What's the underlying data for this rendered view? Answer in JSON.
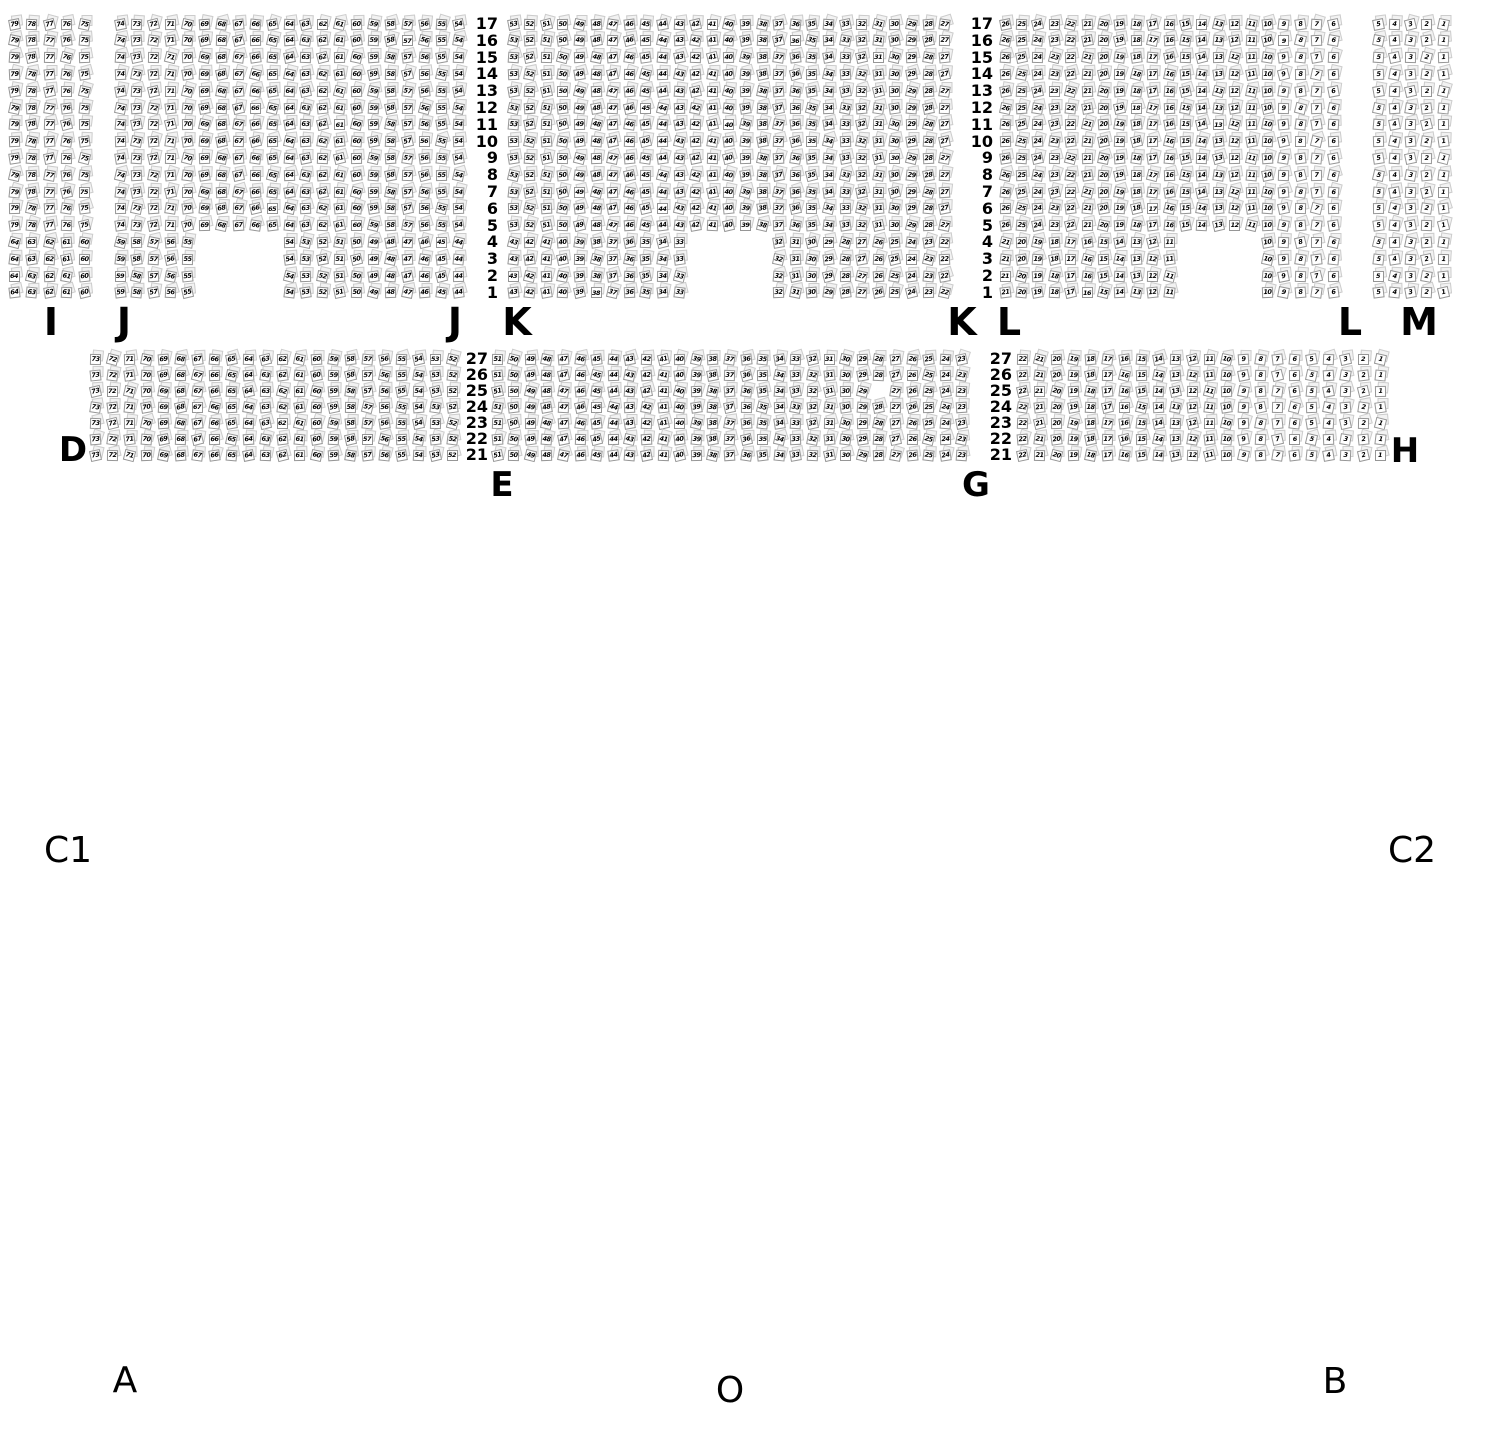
{
  "section_labels": {
    "tier1": [
      "I",
      "J",
      "J",
      "K",
      "K",
      "L",
      "L",
      "M"
    ],
    "tier2": [
      "D",
      "E",
      "G",
      "H"
    ]
  },
  "floor_labels": [
    "C1",
    "C2",
    "A",
    "O",
    "B"
  ],
  "tier1": {
    "row_numbers": [
      17,
      16,
      15,
      14,
      13,
      12,
      11,
      10,
      9,
      8,
      7,
      6,
      5,
      4,
      3,
      2,
      1
    ],
    "blocks": [
      {
        "id": "I",
        "groups": [
          {
            "rows": [
              17,
              5
            ],
            "segments": [
              {
                "from": 79,
                "to": 75,
                "col": 0
              }
            ]
          },
          {
            "rows": [
              4,
              1
            ],
            "segments": [
              {
                "from": 64,
                "to": 60,
                "col": 0
              }
            ]
          }
        ]
      },
      {
        "id": "J",
        "groups": [
          {
            "rows": [
              17,
              5
            ],
            "segments": [
              {
                "from": 74,
                "to": 54,
                "col": 0
              }
            ]
          },
          {
            "rows": [
              4,
              1
            ],
            "segments": [
              {
                "from": 59,
                "to": 55,
                "col": 0
              },
              {
                "from": 54,
                "to": 44,
                "col": 10
              }
            ]
          }
        ]
      },
      {
        "id": "K",
        "groups": [
          {
            "rows": [
              17,
              5
            ],
            "segments": [
              {
                "from": 53,
                "to": 27,
                "col": 0
              }
            ]
          },
          {
            "rows": [
              4,
              1
            ],
            "segments": [
              {
                "from": 43,
                "to": 33,
                "col": 0
              },
              {
                "from": 32,
                "to": 22,
                "col": 16
              }
            ]
          }
        ]
      },
      {
        "id": "L",
        "groups": [
          {
            "rows": [
              17,
              5
            ],
            "segments": [
              {
                "from": 26,
                "to": 6,
                "col": 0
              }
            ]
          },
          {
            "rows": [
              4,
              1
            ],
            "segments": [
              {
                "from": 21,
                "to": 11,
                "col": 0
              },
              {
                "from": 10,
                "to": 6,
                "col": 16
              }
            ]
          }
        ]
      },
      {
        "id": "M",
        "groups": [
          {
            "rows": [
              17,
              1
            ],
            "segments": [
              {
                "from": 5,
                "to": 1,
                "col": 0
              }
            ]
          }
        ]
      }
    ]
  },
  "tier2": {
    "row_numbers": [
      27,
      26,
      25,
      24,
      23,
      22,
      21
    ],
    "blocks": [
      {
        "id": "D",
        "groups": [
          {
            "rows": [
              27,
              21
            ],
            "segments": [
              {
                "from": 73,
                "to": 52,
                "col": 0
              }
            ]
          }
        ]
      },
      {
        "id": "E",
        "groups": [
          {
            "rows": [
              27,
              21
            ],
            "segments": [
              {
                "from": 51,
                "to": 23,
                "col": 0
              }
            ]
          }
        ],
        "missing": [
          {
            "row": 25,
            "seat": 28
          }
        ]
      },
      {
        "id": "H",
        "groups": [
          {
            "rows": [
              27,
              21
            ],
            "segments": [
              {
                "from": 22,
                "to": 1,
                "col": 0
              }
            ]
          }
        ]
      }
    ]
  },
  "colors": {
    "background": "#ffffff",
    "seat_fill": "#ffffff",
    "seat_border": "#969696",
    "ghost_fill": "#f2f2f2",
    "ghost_border": "#cccccc",
    "number": "#000000",
    "label": "#000000"
  }
}
